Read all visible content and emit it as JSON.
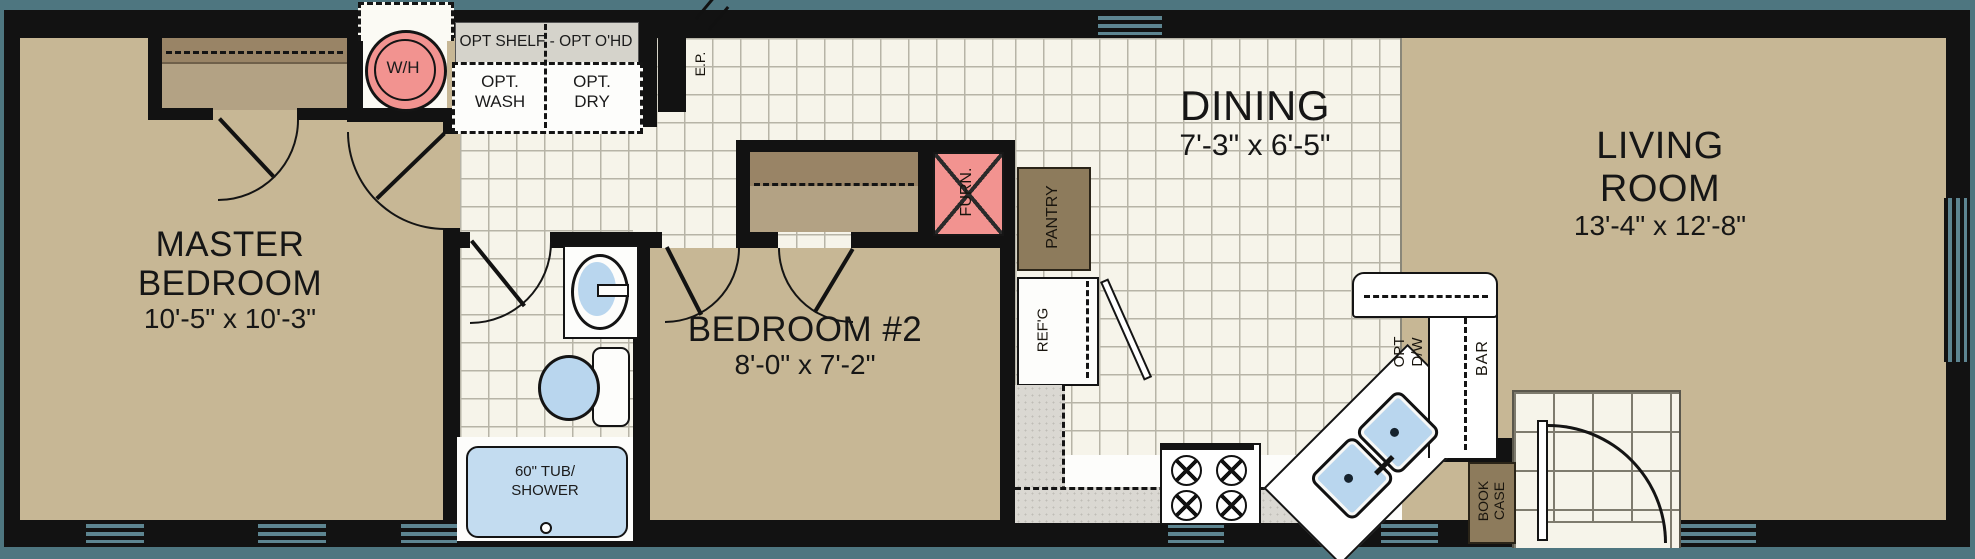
{
  "plan": {
    "rooms": {
      "master_bedroom": {
        "line1": "MASTER",
        "line2": "BEDROOM",
        "dims": "10'-5\" x 10'-3\""
      },
      "bedroom2": {
        "name": "BEDROOM #2",
        "dims": "8'-0\" x 7'-2\""
      },
      "dining": {
        "name": "DINING",
        "dims": "7'-3\" x 6'-5\""
      },
      "living_room": {
        "line1": "LIVING",
        "line2": "ROOM",
        "dims": "13'-4\" x 12'-8\""
      }
    },
    "labels": {
      "water_heater": "W/H",
      "opt_shelf": "OPT SHELF - OPT O'HD",
      "opt_wash_1": "OPT.",
      "opt_wash_2": "WASH",
      "opt_dry_1": "OPT.",
      "opt_dry_2": "DRY",
      "electrical_panel": "E.P.",
      "furnace": "FURN.",
      "pantry": "PANTRY",
      "refrigerator": "REF'G",
      "tub_1": "60\" TUB/",
      "tub_2": "SHOWER",
      "dishwasher_1": "OPT",
      "dishwasher_2": "D/W",
      "bar": "BAR",
      "bookcase_1": "BOOK",
      "bookcase_2": "CASE"
    },
    "colors": {
      "background": "#4e7680",
      "wall": "#121212",
      "room_tan": "#c7b795",
      "closet_dark": "#998466",
      "closet_light": "#b3a284",
      "tile": "#f6f4ea",
      "utility_gray": "#d5d3cb",
      "counter_gray": "#dad8d2",
      "cabinet_brown": "#8d7b5c",
      "equipment_pink": "#f29390",
      "fixture_blue": "#b9d6ee",
      "window_glass": "#5d8591"
    }
  }
}
